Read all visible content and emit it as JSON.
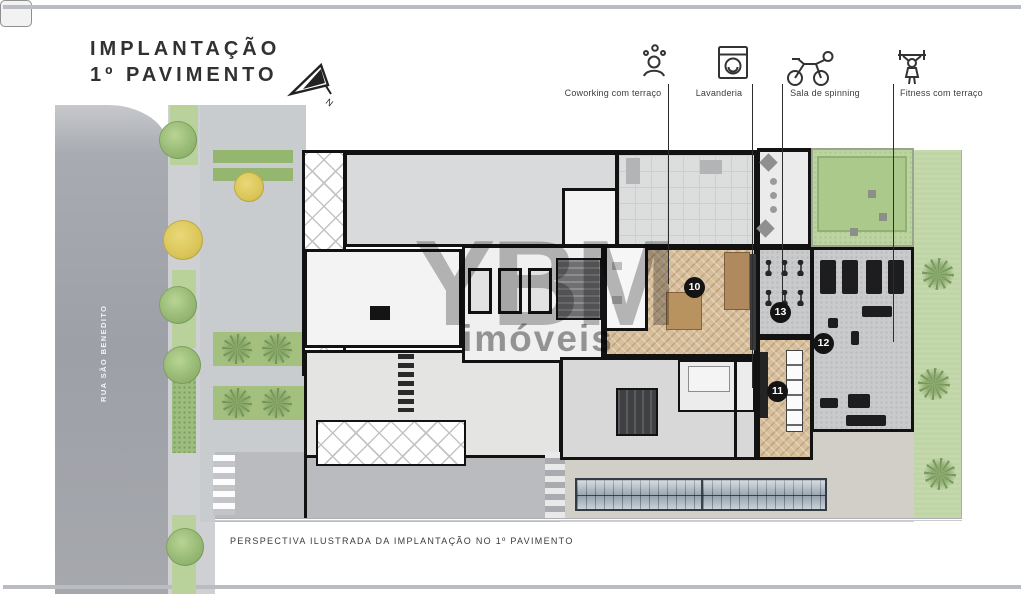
{
  "title": {
    "line1": "IMPLANTAÇÃO",
    "line2": "1º PAVIMENTO"
  },
  "compass": {
    "label": "N"
  },
  "legend": {
    "items": [
      {
        "label": "Coworking com terraço",
        "icon": "coworking-people-icon"
      },
      {
        "label": "Lavanderia",
        "icon": "washing-machine-icon"
      },
      {
        "label": "Sala de spinning",
        "icon": "spinning-bike-icon"
      },
      {
        "label": "Fitness com terraço",
        "icon": "fitness-barbell-icon"
      }
    ]
  },
  "street": {
    "name": "RUA SÃO BENEDITO"
  },
  "markers": [
    {
      "number": "10"
    },
    {
      "number": "11"
    },
    {
      "number": "12"
    },
    {
      "number": "13"
    }
  ],
  "watermark": {
    "brand": "YBM",
    "subtitle": "imóveis"
  },
  "caption": "PERSPECTIVA ILUSTRADA DA IMPLANTAÇÃO NO 1º PAVIMENTO",
  "colors": {
    "wall": "#121212",
    "street": "#a2a5ab",
    "sidewalk": "#ced0d4",
    "garden": "#bcd4a0",
    "wood_floor": "#d8bf9b",
    "glass_roof": "#b9c4cd"
  }
}
